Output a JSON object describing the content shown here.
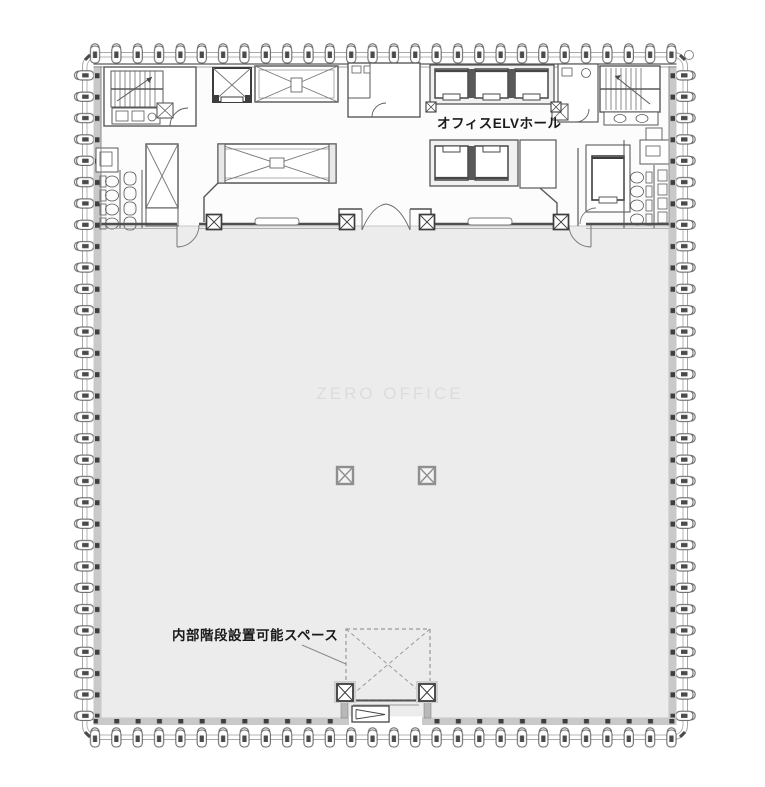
{
  "labels": {
    "elv_hall": "オフィスELVホール",
    "stair_space": "内部階段設置可能スペース",
    "watermark": "ZERO OFFICE"
  },
  "colors": {
    "floor_fill": "#ececec",
    "line": "#5a5a5a",
    "wall_band": "#c9c9c9",
    "tick": "#3f3f3f",
    "watermark": "#dcdcdc",
    "dashed_line": "#9a9a9a",
    "gray_column": "#8f8f8f",
    "label_text": "#1a1a1a"
  }
}
